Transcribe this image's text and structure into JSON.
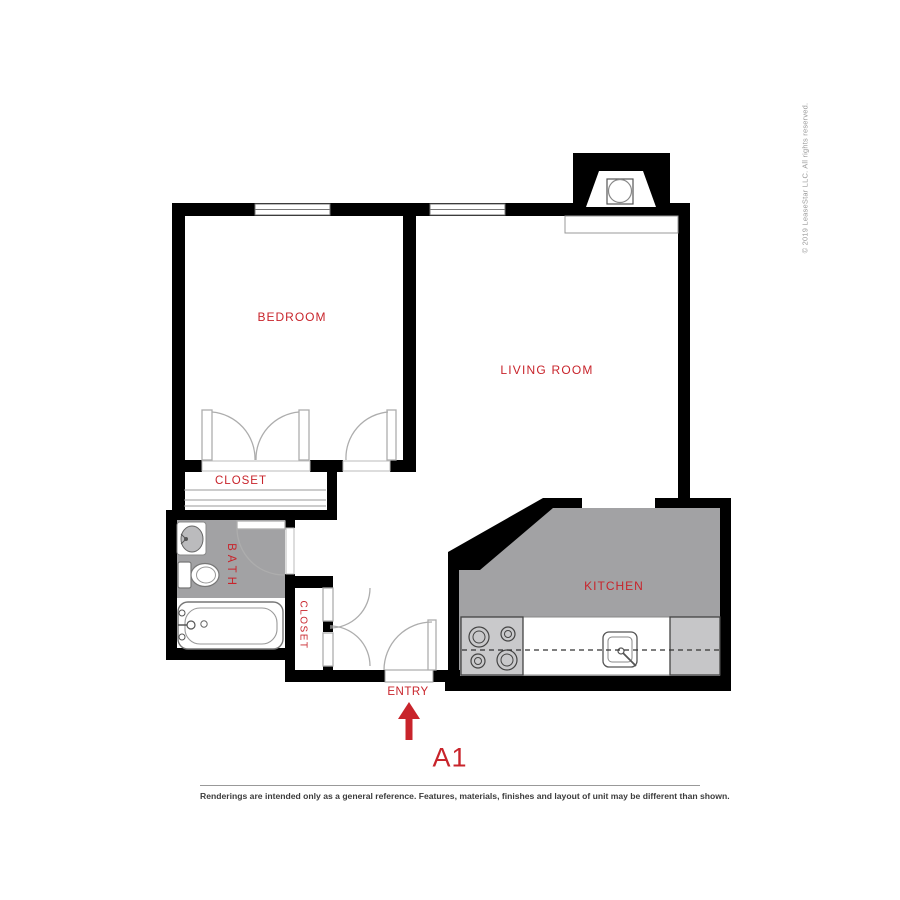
{
  "labels": {
    "bedroom": "BEDROOM",
    "living_room": "LIVING ROOM",
    "kitchen": "KITCHEN",
    "bath": "BATH",
    "closet_bedroom": "CLOSET",
    "closet_hall": "CLOSET",
    "entry": "ENTRY",
    "unit": "A1"
  },
  "colors": {
    "accent_red": "#C8242B",
    "wall_black": "#000000",
    "room_gray": "#A2A2A4",
    "appliance_gray": "#C9C9CB",
    "line_gray": "#AAAAAA"
  },
  "copyright": {
    "text": "© 2019 LeaseStar LLC. All rights reserved."
  },
  "footer": {
    "disclaimer": "Renderings are intended only as a general reference. Features, materials, finishes and layout of unit may be different than shown."
  }
}
